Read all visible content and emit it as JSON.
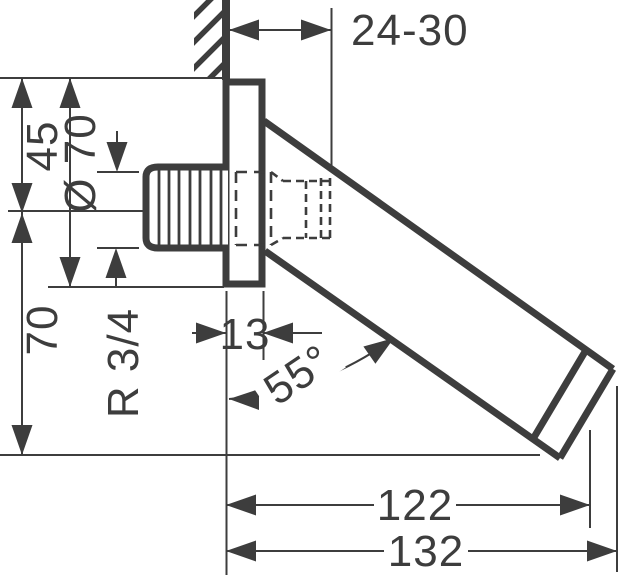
{
  "drawing": {
    "kind": "technical-dimension-drawing",
    "subject": "wall-mounted angled bath spout with escutcheon and threaded connector",
    "colors": {
      "ink": "#3d3d3d",
      "background": "#ffffff"
    },
    "labels": {
      "wall_clearance": "24-30",
      "plate_top_to_axis": "45",
      "plate_diameter": "Ø 70",
      "axis_to_outlet_drop": "70",
      "plate_depth": "13",
      "thread_size": "R 3/4",
      "spout_angle": "55°",
      "spray_face_reach": "122",
      "overall_reach": "132"
    }
  }
}
